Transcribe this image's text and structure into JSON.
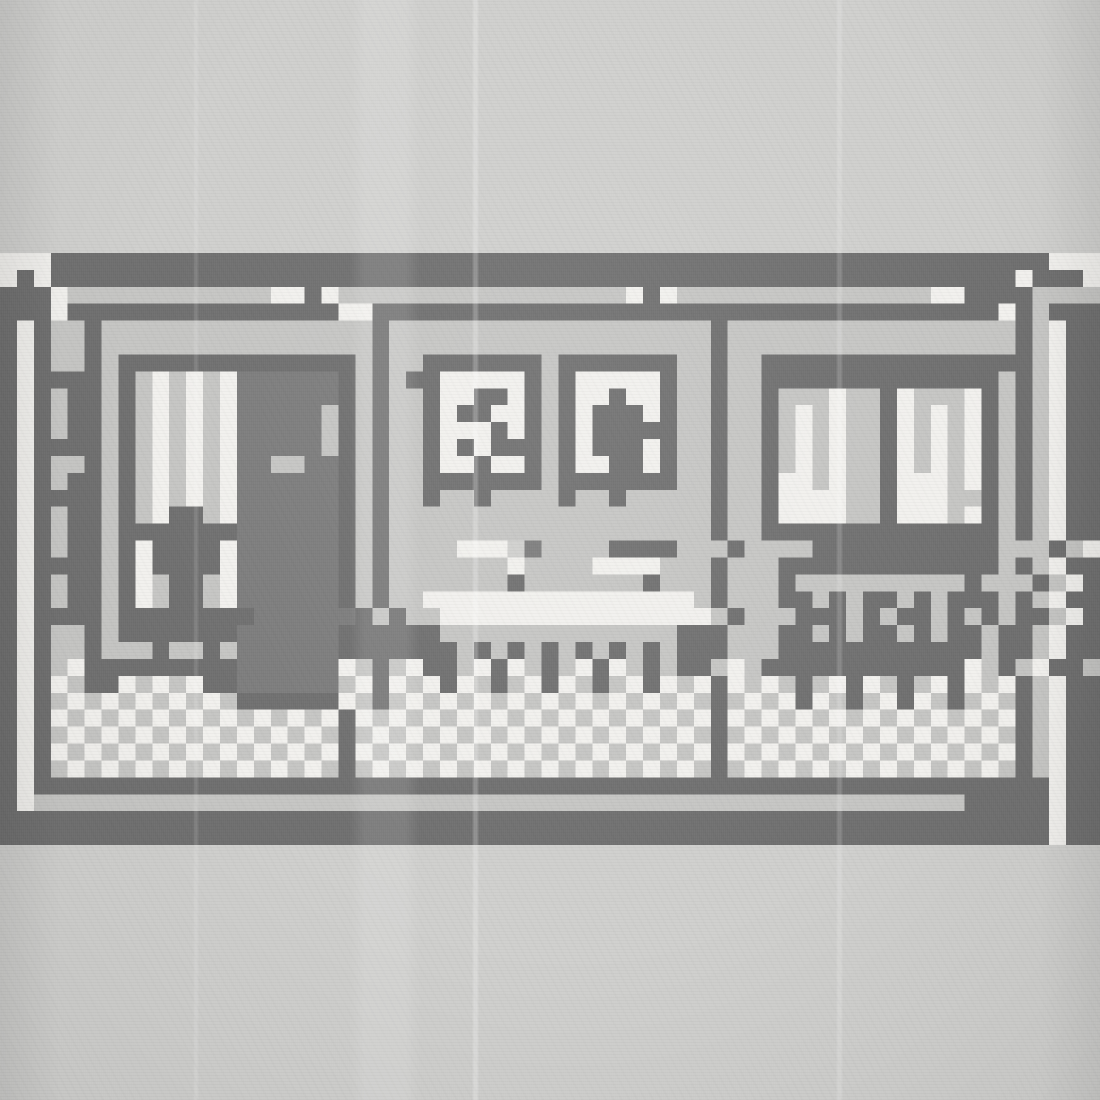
{
  "scene": {
    "palette": {
      "#": "#707070",
      ".": "#c6c6c4",
      "w": "#f2f1ee",
      "m": "#7d7d7d",
      " ": "rgba(0,0,0,0)"
    },
    "background_color": "#d0d0ce",
    "grid": [
      "www###########################################################www",
      "w#w#########################################################w###w",
      "###w............ww#w.................w#w...............ww####",
      "###w################ww#####################################w#.###",
      "#w#..#................#...................#.................#.w##",
      "#w#..#................#...................#.................#.w##",
      "#w#..#.##############.#..#######.#######..#..################.w##",
      "#w####.#.w.w.wmmmmmm#.#.##wwwww#.#wwwww#..#..##############.#.w##",
      "#w#.##.#.w.w.wmmmmmm#.#..#ww##w#.#ww#ww#..#..#...w..#w...w#.#.w##",
      "#w#.##.#.w.w.wmmmmm.#.#..#w##ww#.#w###w#..#..#.w.w..#w.w.w#.#.w##",
      "#w#.##.#.w.w.wmmmmm.#.#..#www#w#.#w#####..#..#.w.w..#w.w.w#.#.w##",
      "#w####.#.w.w.wmmmmm.#.#..#w#w###.#w###w#..#..#.w.w..#w.w.w#.#.w##",
      "#w#..#.#.w.w.wmm..mm#.#..#ww#ww#.#ww##w#..#..#.w.w..#w.w.w#.#.w##",
      "#w#.##.#.w.w.wmmmmmm#.#..#######.#######..#..#ww.w..#www.w#.#.w##",
      "#w####.#.w.w.wmmmmmm#.#..#..#....#..#.....#..#wwww..#www..#.#.w##",
      "#w#.##.#.w##.wmmmmmm#.#...................#..#wwww..#www.w#.#.w##",
      "#w#.##.#######mmmmmm#.#...................#..##############.#.w##",
      "#w#.##.#w####wmmmmmm#.#....www m....####...#....###########...#.w##",
      "#w####.#w####wmmmmmm#.#.......w....wwww...#...#############.#.w##",
      "#w#.##.#w.##.wmmmmmm#.#.......#.......#...#...#..........#...#.w##",
      "#w#.##.#w.##.wmmmmmm#.#..wwwwwwwwwwwwwwww.#...##.#.##.#.###.#.w##",
      "#w####.########mmmmmm#.#..wwwwwwwwwwwwwwww.#...###.#.##.#.#.##.w##",
      "#w#..#.#######mmmmmm######..............###...##.#.##.#.##.##.w##",
      "#w#..#...#..#.mmmmmm#######.#.#.#.#.#.#.###...############.##.w##",
      "#w#.w#########mmmmmmw.#.w##.w#w.#.w#w.#.##.w.############w.#.w##",
      "#w#w.##w.w.w##mmmmmm.w#w.w#w.#.w#w.#.w#w.w#w.w.#.w#w.#.w#w.w#.w##",
      "#w#.w.w.w.w.w.######w.#.w.w.w.w.w.w.w.w.w.#.w.w#w.#.w#w.#.w.#.w##",
      "#w#w.w.w.w.w.w.w.w.w#w.w.w.w.w.w.w.w.w.w.w#w.w.w.w.w.w.w.w.w#.w##",
      "#w#.w.w.w.w.w.w.w.w.#.w.w.w.w.w.w.w.w.w.w.#.w.w.w.w.w.w.w.w.#.w##",
      "#w#w.w.w.w.w.w.w.w.w#w.w.w.w.w.w.w.w.w.w.w#w.w.w.w.w.w.w.w.w#.w##",
      "#w#.w.w.w.w.w.w.w.w.#.w.w.w.w.w.w.w.w.w.w.#.w.w.w.w.w.w.w.w.#.w##",
      "#w############################################################w##",
      "#w.......................................................#####w##",
      "##############################################################w##",
      "##############################################################w##"
    ],
    "grid_cols": 65,
    "grid_rows": 35,
    "objects": [
      {
        "name": "building-frame",
        "x": 0,
        "y": 253,
        "w": 1100,
        "h": 592,
        "interactable": false
      },
      {
        "name": "room-left",
        "x": 51,
        "y": 321,
        "w": 321,
        "h": 457,
        "interactable": false
      },
      {
        "name": "room-middle",
        "x": 389,
        "y": 321,
        "w": 321,
        "h": 457,
        "interactable": false
      },
      {
        "name": "room-right",
        "x": 728,
        "y": 321,
        "w": 287,
        "h": 457,
        "interactable": false
      },
      {
        "name": "door",
        "x": 237,
        "y": 371,
        "w": 101,
        "h": 321,
        "interactable": true
      },
      {
        "name": "door-handle",
        "x": 271,
        "y": 456,
        "w": 34,
        "h": 17,
        "interactable": true
      },
      {
        "name": "window-left",
        "x": 118,
        "y": 354,
        "w": 118,
        "h": 288,
        "interactable": true
      },
      {
        "name": "curtains",
        "x": 135,
        "y": 371,
        "w": 102,
        "h": 152,
        "interactable": false
      },
      {
        "name": "plant",
        "x": 152,
        "y": 507,
        "w": 68,
        "h": 135,
        "interactable": true
      },
      {
        "name": "bench",
        "x": 85,
        "y": 642,
        "w": 152,
        "h": 68,
        "interactable": true
      },
      {
        "name": "wall-shelf",
        "x": 51,
        "y": 371,
        "w": 34,
        "h": 271,
        "interactable": false
      },
      {
        "name": "picture-left",
        "x": 423,
        "y": 354,
        "w": 118,
        "h": 152,
        "interactable": true
      },
      {
        "name": "picture-right",
        "x": 558,
        "y": 354,
        "w": 118,
        "h": 152,
        "interactable": true
      },
      {
        "name": "table",
        "x": 423,
        "y": 591,
        "w": 271,
        "h": 101,
        "interactable": true
      },
      {
        "name": "box-left",
        "x": 457,
        "y": 540,
        "w": 68,
        "h": 51,
        "interactable": true
      },
      {
        "name": "box-right",
        "x": 592,
        "y": 540,
        "w": 68,
        "h": 51,
        "interactable": true
      },
      {
        "name": "window-right",
        "x": 761,
        "y": 354,
        "w": 237,
        "h": 186,
        "interactable": true
      },
      {
        "name": "cabinet",
        "x": 778,
        "y": 540,
        "w": 203,
        "h": 169,
        "interactable": true
      },
      {
        "name": "floor-left",
        "x": 51,
        "y": 659,
        "w": 321,
        "h": 118,
        "interactable": false
      },
      {
        "name": "floor-middle",
        "x": 389,
        "y": 659,
        "w": 321,
        "h": 118,
        "interactable": false
      },
      {
        "name": "floor-right",
        "x": 728,
        "y": 659,
        "w": 287,
        "h": 118,
        "interactable": false
      },
      {
        "name": "divider-left",
        "x": 372,
        "y": 287,
        "w": 17,
        "h": 507,
        "interactable": false
      },
      {
        "name": "divider-right",
        "x": 711,
        "y": 287,
        "w": 17,
        "h": 507,
        "interactable": false
      }
    ]
  }
}
